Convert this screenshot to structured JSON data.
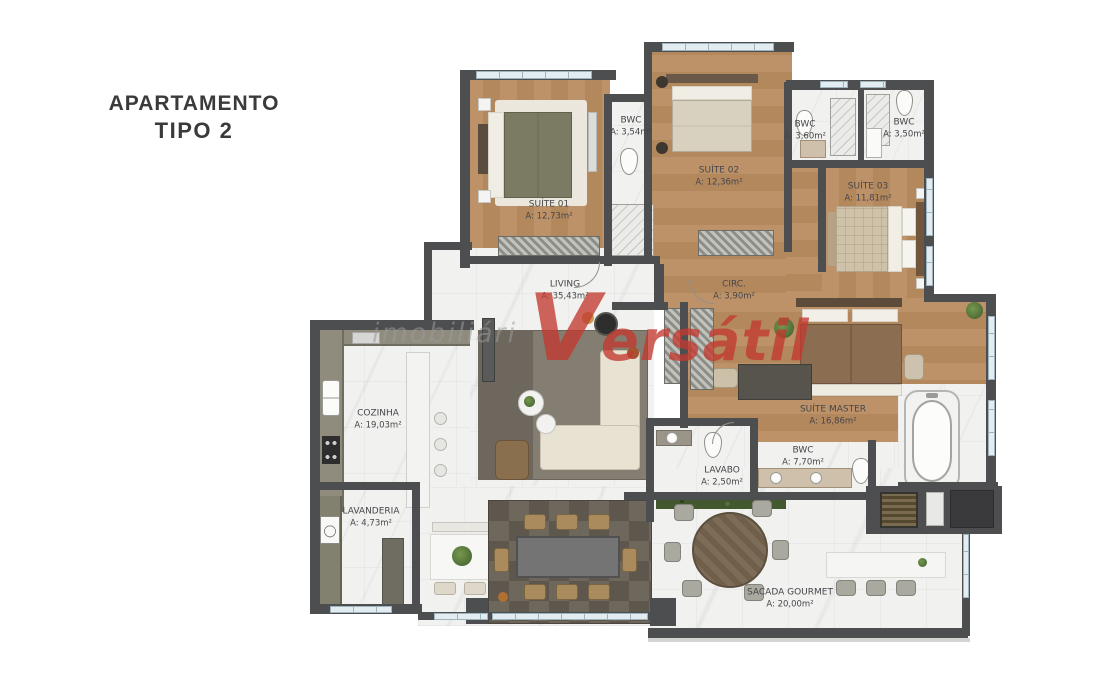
{
  "title": {
    "line1": "APARTAMENTO",
    "line2": "TIPO 2"
  },
  "watermark": {
    "prefix": "imobiliári",
    "brand": "Versátil"
  },
  "colors": {
    "wall": "#4d4e50",
    "wood_floor": "#b78f63",
    "marble_floor": "#f1f1ef",
    "watermark_red": "#c23a30",
    "title_text": "#3a3a3c",
    "hedge_green": "#44582f",
    "window_glass": "#e3ecf1"
  },
  "rooms": [
    {
      "id": "suite-01",
      "name": "SUÍTE 01",
      "area": "A: 12,73m²"
    },
    {
      "id": "bwc-suite-01",
      "name": "BWC",
      "area": "A: 3,54m²"
    },
    {
      "id": "suite-02",
      "name": "SUÍTE 02",
      "area": "A: 12,36m²"
    },
    {
      "id": "bwc-suite-02",
      "name": "BWC",
      "area": "A: 3,60m²"
    },
    {
      "id": "bwc-suite-03",
      "name": "BWC",
      "area": "A: 3,50m²"
    },
    {
      "id": "suite-03",
      "name": "SUÍTE 03",
      "area": "A: 11,81m²"
    },
    {
      "id": "living",
      "name": "LIVING",
      "area": "A: 35,43m²"
    },
    {
      "id": "circ",
      "name": "CIRC.",
      "area": "A: 3,90m²"
    },
    {
      "id": "cozinha",
      "name": "COZINHA",
      "area": "A: 19,03m²"
    },
    {
      "id": "lavanderia",
      "name": "LAVANDERIA",
      "area": "A: 4,73m²"
    },
    {
      "id": "suite-master",
      "name": "SUÍTE MASTER",
      "area": "A: 16,86m²"
    },
    {
      "id": "bwc-master",
      "name": "BWC",
      "area": "A: 7,70m²"
    },
    {
      "id": "lavabo",
      "name": "LAVABO",
      "area": "A: 2,50m²"
    },
    {
      "id": "sacada",
      "name": "SACADA GOURMET",
      "area": "A: 20,00m²"
    }
  ]
}
